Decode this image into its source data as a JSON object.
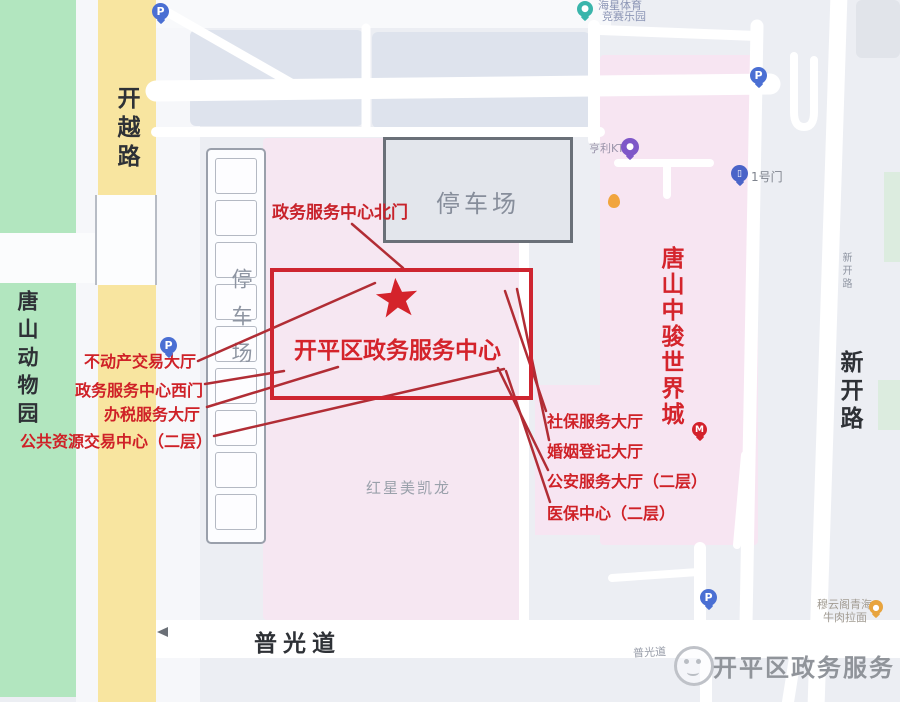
{
  "roads": {
    "kaiyue": "开越路",
    "xinkai": "新开路",
    "xinkai_small": "新开路",
    "puguang": "普光道",
    "puguang_small": "普光道"
  },
  "areas": {
    "zoo": "唐山动物园",
    "parking_strip": "停车场",
    "parking_lot": "停车场",
    "hongxing_building": "红星美凯龙",
    "zhongjun_building": "唐山中骏世界城"
  },
  "service_center": {
    "title": "开平区政务服务中心",
    "north_gate_label": "政务服务中心北门"
  },
  "halls": {
    "left": [
      "不动产交易大厅",
      "政务服务中心西门",
      "办税服务大厅",
      "公共资源交易中心（二层）"
    ],
    "right": [
      "社保服务大厅",
      "婚姻登记大厅",
      "公安服务大厅（二层）",
      "医保中心（二层）"
    ]
  },
  "pois": {
    "sports_line1": "海星体育",
    "sports_line2": "竞赛乐园",
    "ktv": "亨利KTV",
    "gate1": "1号门",
    "noodle_line1": "穆云阁青海",
    "noodle_line2": "牛肉拉面"
  },
  "markers": {
    "parking_letter": "P",
    "mcdonalds_letter": "M"
  },
  "watermark": {
    "text": "开平区政务服务"
  },
  "colors": {
    "accent_red": "#cf2127",
    "annotation_line": "#b12d35",
    "road_yellow": "#f8e5a0",
    "green_area": "#b2e6bf",
    "pink_building": "#f6e7f2",
    "pin_blue": "#4a6fd3",
    "map_bg": "#eceef3"
  }
}
